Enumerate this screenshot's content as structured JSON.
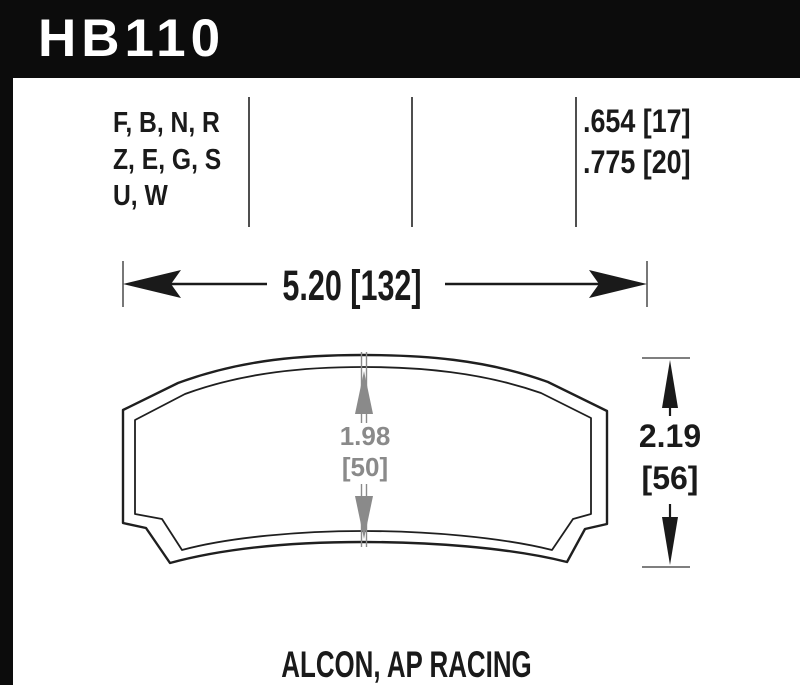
{
  "part_number": "HB110",
  "compound_lines": [
    "F, B, N, R",
    "Z, E, G, S",
    "U, W"
  ],
  "thickness_lines": [
    ".654 [17]",
    ".775 [20]"
  ],
  "dimensions": {
    "width_label": "5.20 [132]",
    "height_in": "2.19",
    "height_mm": "[56]",
    "center_height_in": "1.98",
    "center_height_mm": "[50]"
  },
  "applications": "ALCON, AP RACING",
  "colors": {
    "header_bg": "#0c0c0c",
    "text": "#1a1a1a",
    "dimension_gray": "#8a8a8a",
    "tick_gray": "#555555"
  }
}
